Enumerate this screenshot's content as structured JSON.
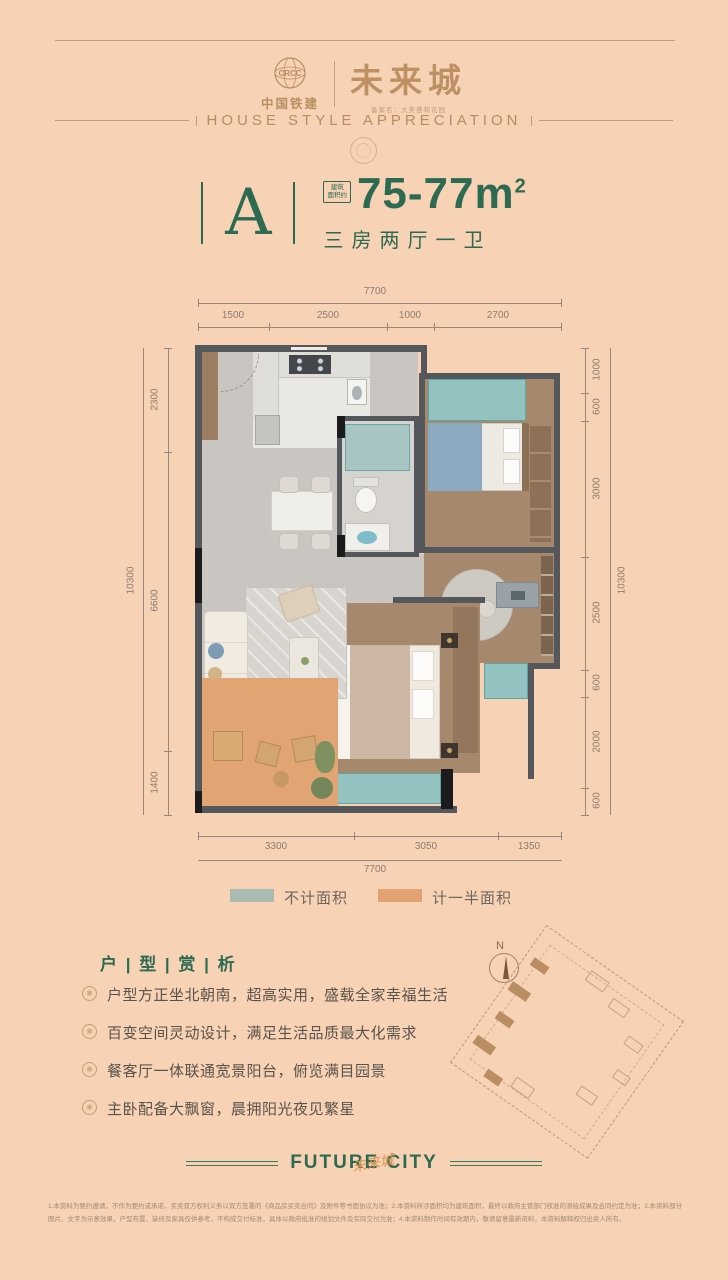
{
  "page": {
    "background": "#f7d2b5",
    "accent_green": "#2d6a52",
    "accent_bronze": "#bd9164"
  },
  "header": {
    "brand_name": "中国铁建",
    "brand_logo_text": "CRCC",
    "project_name": "未来城",
    "project_subtitle": "备案名：大美荟和花园",
    "banner": "HOUSE STYLE APPRECIATION"
  },
  "unit": {
    "letter": "A",
    "badge_line1": "建筑",
    "badge_line2": "面积约",
    "area_value": "75-77m",
    "area_sup": "2",
    "rooms": "三房两厅一卫"
  },
  "plan": {
    "dims_top": {
      "total": "7700",
      "segments": [
        "1500",
        "2500",
        "1000",
        "2700"
      ]
    },
    "dims_bottom": {
      "total": "7700",
      "segments": [
        "3300",
        "3050",
        "1350"
      ]
    },
    "dims_left": {
      "outer": "10300",
      "segments": [
        "2300",
        "6600",
        "1400"
      ]
    },
    "dims_right": {
      "outer": "10300",
      "segments": [
        "1000",
        "600",
        "3000",
        "2500",
        "600",
        "2000",
        "600"
      ]
    }
  },
  "legend": {
    "items": [
      {
        "label": "不计面积",
        "color": "#a9bab1"
      },
      {
        "label": "计一半面积",
        "color": "#e2a271"
      }
    ]
  },
  "analysis": {
    "title": "户 | 型 | 赏 | 析",
    "icon": "❋",
    "bullets": [
      "户型方正坐北朝南，超高实用，盛载全家幸福生活",
      "百变空间灵动设计，满足生活品质最大化需求",
      "餐客厅一体联通宽景阳台，俯览满目园景",
      "主卧配备大飘窗，晨拥阳光夜见繁星"
    ]
  },
  "sitemap": {
    "north": "N"
  },
  "footer": {
    "slogan": "FUTURE CITY",
    "slogan_script": "未来城",
    "disclaimer": "1.本资料为要约邀请，不作为要约或承诺，买卖双方权利义务以双方签署的《商品房买卖合同》及附件等书面协议为准；2.本资料所涉面积均为建筑面积，最终以政府主管部门核准的测绘成果及合同约定为准；3.本资料部分图片、文字为示意效果，户型布置、装修及家具仅供参考，不构成交付标准，具体以政府批准的规划文件及实际交付为准；4.本资料制作时间有效期内，敬请留意最新资料，本资料解释权归出卖人所有。"
  }
}
